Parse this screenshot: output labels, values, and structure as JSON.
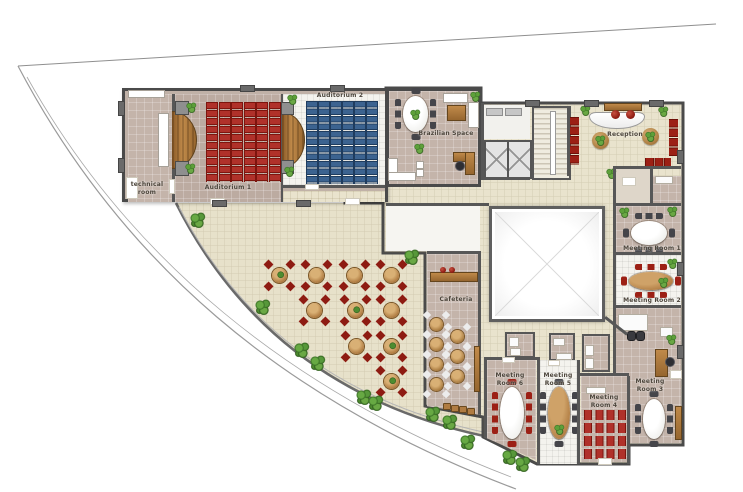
{
  "rooms": {
    "technical_room": "technical room",
    "auditorium_1": "Auditorium 1",
    "auditorium_2": "Auditorium 2",
    "brazilian_space": "Brazilian Space",
    "reception": "Reception",
    "cafeteria": "Cafeteria",
    "meeting_room_1": "Meeting Room 1",
    "meeting_room_2": "Meeting Room 2",
    "meeting_room_3": "Meeting Room 3",
    "meeting_room_4": "Meeting Room 4",
    "meeting_room_5": "Meeting Room 5",
    "meeting_room_6": "Meeting Room 6"
  },
  "colors": {
    "auditorium1_seats": "#b0312a",
    "auditorium2_seats": "#3c6390",
    "taupe_floor": "#c4b4aa",
    "beige_tile_floor": "#e9e3cd",
    "white_tile_floor": "#f4f3ee",
    "wall": "#575757",
    "wood": "#b07c42",
    "red_chairs": "#9c2015",
    "plant_green": "#3b7426"
  }
}
